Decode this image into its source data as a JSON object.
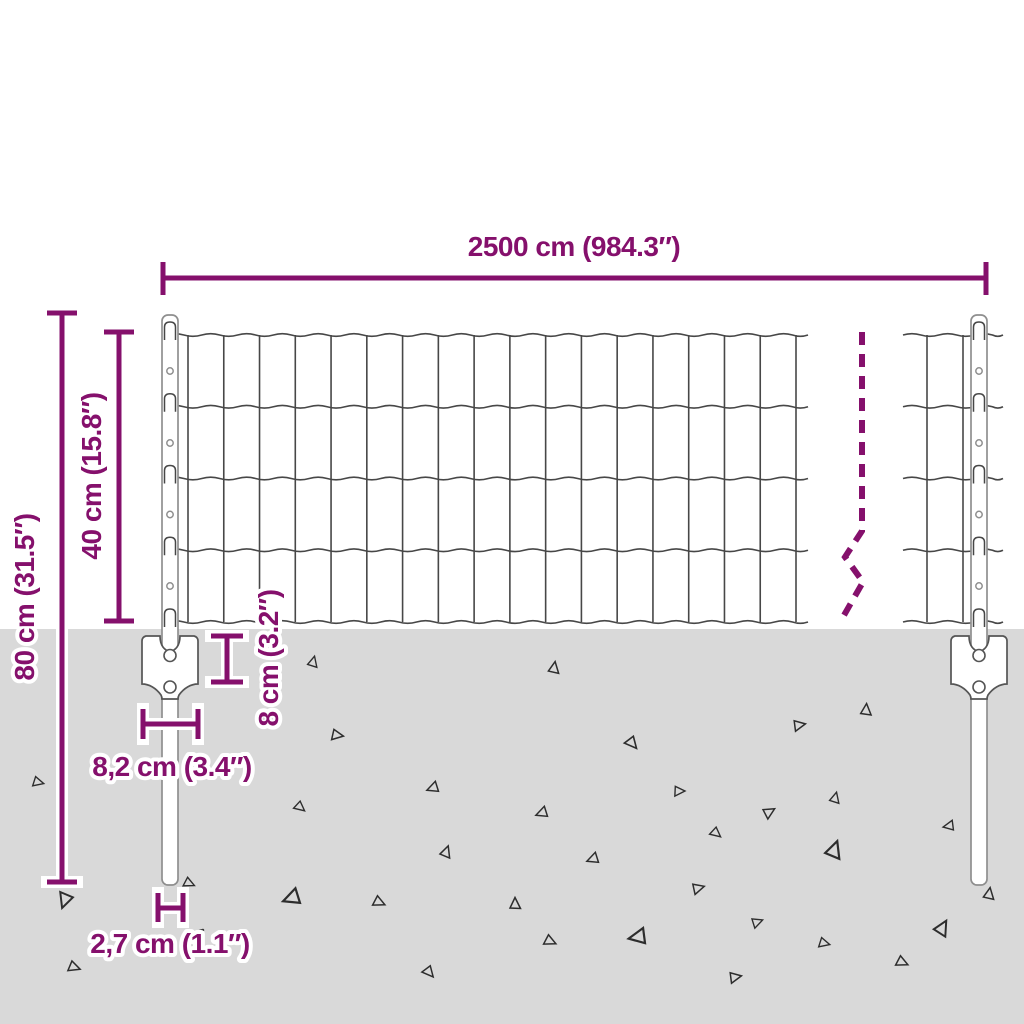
{
  "title": "Fence with posts — dimension diagram",
  "colors": {
    "accent": "#85106C",
    "wire": "#474747",
    "post_outline": "#8F8F8F",
    "bracket_outline": "#555555",
    "ground": "#D9D9D9",
    "triangle": "#2D2D2D",
    "background": "#FFFFFF",
    "halo": "#FFFFFF"
  },
  "measurements": {
    "total_width": "2500 cm (984.3″)",
    "post_height": "80 cm (31.5″)",
    "mesh_height": "40 cm (15.8″)",
    "anchor_plate_height": "8 cm (3.2″)",
    "anchor_plate_width": "8,2 cm (3.4″)",
    "post_diameter": "2,7 cm (1.1″)"
  },
  "scene": {
    "ground_top": 629,
    "fence": {
      "wire_ys": [
        335,
        406.75,
        478.5,
        550.25,
        622
      ],
      "sections": [
        {
          "span": [
            166,
            808
          ],
          "v_start": 188,
          "v_end": 796,
          "v_count": 18
        },
        {
          "span": [
            903,
            1003
          ],
          "v_list": [
            927,
            963
          ]
        }
      ],
      "wave_half_period": 17.9,
      "wave_amp": 2.6
    },
    "posts": {
      "centers": [
        170,
        979
      ],
      "top": 315,
      "bottom": 885,
      "width": 16,
      "hole_ys": [
        371,
        443,
        514.5,
        586
      ],
      "bracket": {
        "top": 636,
        "hole_ys": [
          655.5,
          687
        ],
        "hole_r": 6
      }
    },
    "break_line": "M862,332 V531 L845,557 L863,582 L843,617",
    "triangles": [
      [
        313,
        662,
        12,
        15
      ],
      [
        337,
        735,
        13,
        100
      ],
      [
        38,
        782,
        12,
        105
      ],
      [
        433,
        788,
        13,
        250
      ],
      [
        300,
        807,
        12,
        130
      ],
      [
        446,
        852,
        13,
        20
      ],
      [
        65,
        900,
        17,
        200
      ],
      [
        189,
        883,
        12,
        115
      ],
      [
        292,
        898,
        19,
        250
      ],
      [
        379,
        902,
        13,
        115
      ],
      [
        74,
        967,
        13,
        110
      ],
      [
        429,
        972,
        13,
        140
      ],
      [
        554,
        668,
        13,
        10
      ],
      [
        799,
        725,
        13,
        80
      ],
      [
        866,
        710,
        13,
        5
      ],
      [
        632,
        743,
        14,
        140
      ],
      [
        679,
        791,
        12,
        90
      ],
      [
        542,
        813,
        13,
        250
      ],
      [
        769,
        812,
        13,
        60
      ],
      [
        835,
        798,
        12,
        15
      ],
      [
        716,
        833,
        12,
        130
      ],
      [
        949,
        826,
        12,
        260
      ],
      [
        834,
        850,
        19,
        20
      ],
      [
        593,
        859,
        13,
        250
      ],
      [
        698,
        888,
        13,
        75
      ],
      [
        515,
        904,
        13,
        0
      ],
      [
        757,
        922,
        12,
        70
      ],
      [
        638,
        937,
        19,
        260
      ],
      [
        550,
        941,
        13,
        115
      ],
      [
        824,
        943,
        12,
        105
      ],
      [
        942,
        928,
        17,
        30
      ],
      [
        989,
        894,
        13,
        10
      ],
      [
        902,
        962,
        13,
        115
      ],
      [
        735,
        977,
        13,
        80
      ]
    ]
  }
}
